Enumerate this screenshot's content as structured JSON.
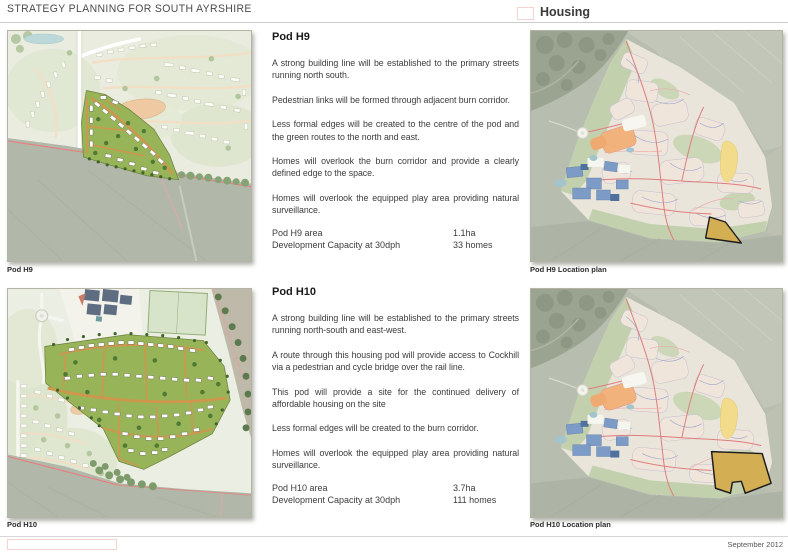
{
  "header": {
    "title": "STRATEGY PLANNING FOR SOUTH AYRSHIRE",
    "section_label": "Housing"
  },
  "footer": {
    "date": "September 2012"
  },
  "colors": {
    "pod_green": "#97b458",
    "pod_road_orange": "#d0964e",
    "location_highlight_tan": "#d3ae52",
    "road_red": "#e87f7f",
    "field_grey_green": "#b1b7a9",
    "rule_grey": "#cbcbcb",
    "box_outline_pink": "#f3d4cf",
    "text_grey": "#3c3c3c"
  },
  "sections": [
    {
      "heading": "Pod H9",
      "paragraphs": [
        "A strong building line will be established to the primary streets running north south.",
        "Pedestrian links will be formed through adjacent burn corridor.",
        "Less formal edges will be created to the centre of the pod and the green routes to the north and east.",
        "Homes will overlook the burn corridor and provide a clearly defined edge to the space.",
        "Homes will overlook the equipped play area providing natural surveillance."
      ],
      "stats": [
        {
          "label": "Pod H9 area",
          "value": "1.1ha"
        },
        {
          "label": "Development Capacity at 30dph",
          "value": "33 homes"
        }
      ],
      "map_caption": "Pod H9",
      "location_caption": "Pod H9 Location plan"
    },
    {
      "heading": "Pod H10",
      "paragraphs": [
        "A strong building line will be established to the primary streets running north-south and east-west.",
        "A route through this housing pod will provide access to Cockhill via a pedestrian and cycle bridge over the rail line.",
        "This pod will provide a site for the continued delivery of affordable housing on the site",
        "Less formal edges will be created to the burn corridor.",
        "Homes will overlook the equipped play area providing natural surveillance."
      ],
      "stats": [
        {
          "label": "Pod H10 area",
          "value": "3.7ha"
        },
        {
          "label": "Development Capacity at 30dph",
          "value": "111 homes"
        }
      ],
      "map_caption": "Pod H10",
      "location_caption": "Pod H10 Location plan"
    }
  ]
}
